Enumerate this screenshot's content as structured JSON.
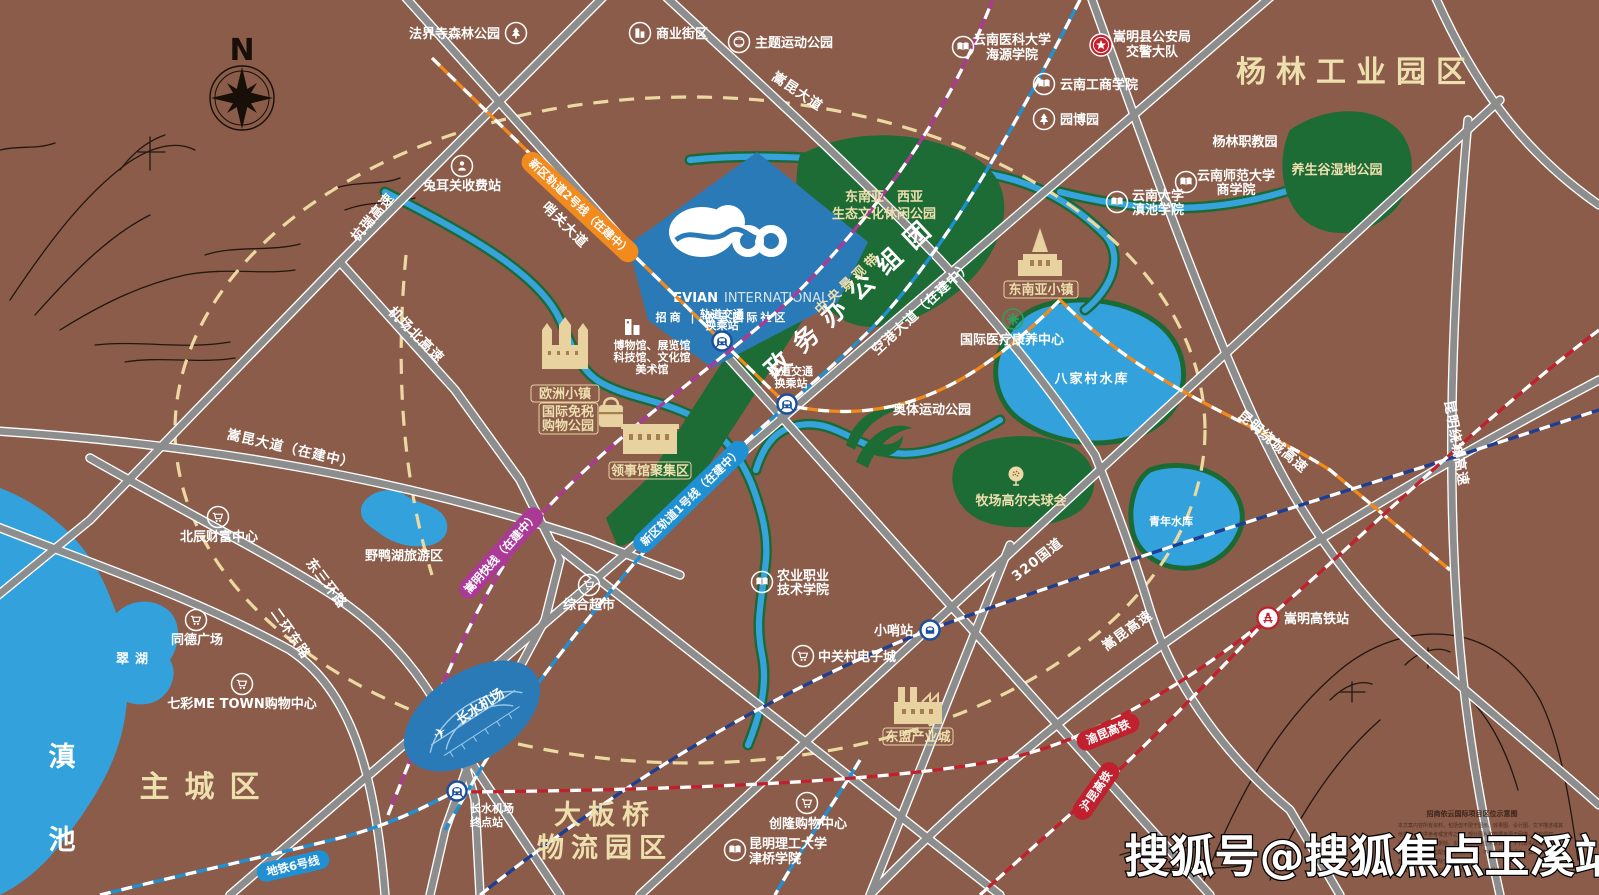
{
  "watermark": "搜狐号@搜狐焦点玉溪站",
  "compass": {
    "north": "N"
  },
  "logo": {
    "en_bold": "EVIAN",
    "en_light": "INTERNATIONAL",
    "cn": "招商 | 依云国际社区"
  },
  "regions": {
    "yanglin_industrial": "杨林工业园区",
    "government_cluster": "政务办公组团",
    "main_city": "主城区",
    "dabanqiao_l1": "大板桥",
    "dabanqiao_l2": "物流园区",
    "dianchi": "滇池"
  },
  "parks": {
    "fajiesi": "法界寺森林公园",
    "theme_sports": "主题运动公园",
    "se_asia_l1": "东南亚、西亚",
    "se_asia_l2": "生态文化休闲公园",
    "central_landscape": "中央景观带",
    "yangshenggu": "养生谷湿地公园",
    "aoti": "奥体运动公园",
    "golf": "牧场高尔夫球会",
    "yeyahu": "野鸭湖旅游区"
  },
  "waters": {
    "bajiacun": "八家村水库",
    "qingnian": "青年水库",
    "cuihu": "翠湖"
  },
  "roads": {
    "songkun_ave": "嵩昆大道",
    "shaoguan_ave": "哨关大道",
    "hangrui_expwy": "杭瑞高速",
    "airport_north_expwy": "机场北高速",
    "songkun_ave_uc": "嵩昆大道（在建中）",
    "east_third_ring": "东三环路",
    "second_ring_east": "二环东路",
    "konggang_ave_uc": "空港大道（在建中）",
    "kunming_ring_expwy": "昆明绕城高速",
    "g320": "320国道",
    "songkun_expwy": "嵩昆高速"
  },
  "rails": {
    "line2_uc": "新区轨道2号线（在建中）",
    "line1_uc": "新区轨道1号线（在建中）",
    "songming_express_uc": "嵩明快线（在建中）",
    "metro_line6": "地铁6号线",
    "yukun_hsr": "渝昆高铁",
    "hukun_hsr": "沪昆高铁"
  },
  "stations": {
    "transfer_l1": "轨道交通",
    "transfer_l2": "换乘站",
    "changshui_terminal_l1": "长水机场",
    "changshui_terminal_l2": "终点站",
    "xiaoshao": "小哨站",
    "songming_hsr": "嵩明高铁站",
    "tuerguan_toll": "兔耳关收费站"
  },
  "pois": {
    "business_street": "商业街区",
    "yn_medical_l1": "云南医科大学",
    "yn_medical_l2": "海源学院",
    "police_l1": "嵩明县公安局",
    "police_l2": "交警大队",
    "yn_tech_business": "云南工商学院",
    "yuanboyuan": "园博园",
    "yanglin_vocational": "杨林职教园",
    "yn_normal_l1": "云南师范大学",
    "yn_normal_l2": "商学院",
    "yn_univ_l1": "云南大学",
    "yn_univ_l2": "滇池学院",
    "intl_medical": "国际医疗康养中心",
    "beichen": "北辰财富中心",
    "tongde": "同德广场",
    "qicai_metown": "七彩ME TOWN购物中心",
    "supermarket": "综合超市",
    "zhongguancun": "中关村电子城",
    "chuanglong": "创隆购物中心",
    "kmust_l1": "昆明理工大学",
    "kmust_l2": "津桥学院",
    "agri_l1": "农业职业",
    "agri_l2": "技术学院",
    "museum_l1": "博物馆、展览馆",
    "museum_l2": "科技馆、文化馆",
    "museum_l3": "美术馆"
  },
  "landmarks": {
    "europe_town": "欧洲小镇",
    "duty_free_l1": "国际免税",
    "duty_free_l2": "购物公园",
    "consulate_zone": "领事馆聚集区",
    "se_asia_town": "东南亚小镇",
    "asean_industry_city": "东盟产业城",
    "changshui_airport": "长水机场"
  },
  "legend": {
    "title": "招商依云国际项目区位示意图",
    "body": [
      "本文案内容所有资料，包括但不限于图示、效果图、设计图、文字描述或其",
      "他资料，仅供参考或宣传之用。部分图片和数据来源于网络，若有侵权，",
      "请及时联系发布者删除。本示意图为区位示意表达，不代表实际比例及",
      "规划，交通及周边配套信息仅供参考，不构成要约或承诺，具体以政府",
      "部门最终规划及实际交付为准。",
      "建议与实际交通规划详见（2017-2035年规划）。"
    ]
  },
  "colors": {
    "background": "#8a5c49",
    "road_gray": "#8d8d8d",
    "water_blue": "#33a2dc",
    "park_green": "#1d6b35",
    "project_blue": "#2b7ab8",
    "cream_text": "#eedfae",
    "capsule_orange": "#f28a1d",
    "capsule_blue": "#2090d5",
    "capsule_magenta": "#ab3a96",
    "capsule_red": "#c1202e"
  }
}
